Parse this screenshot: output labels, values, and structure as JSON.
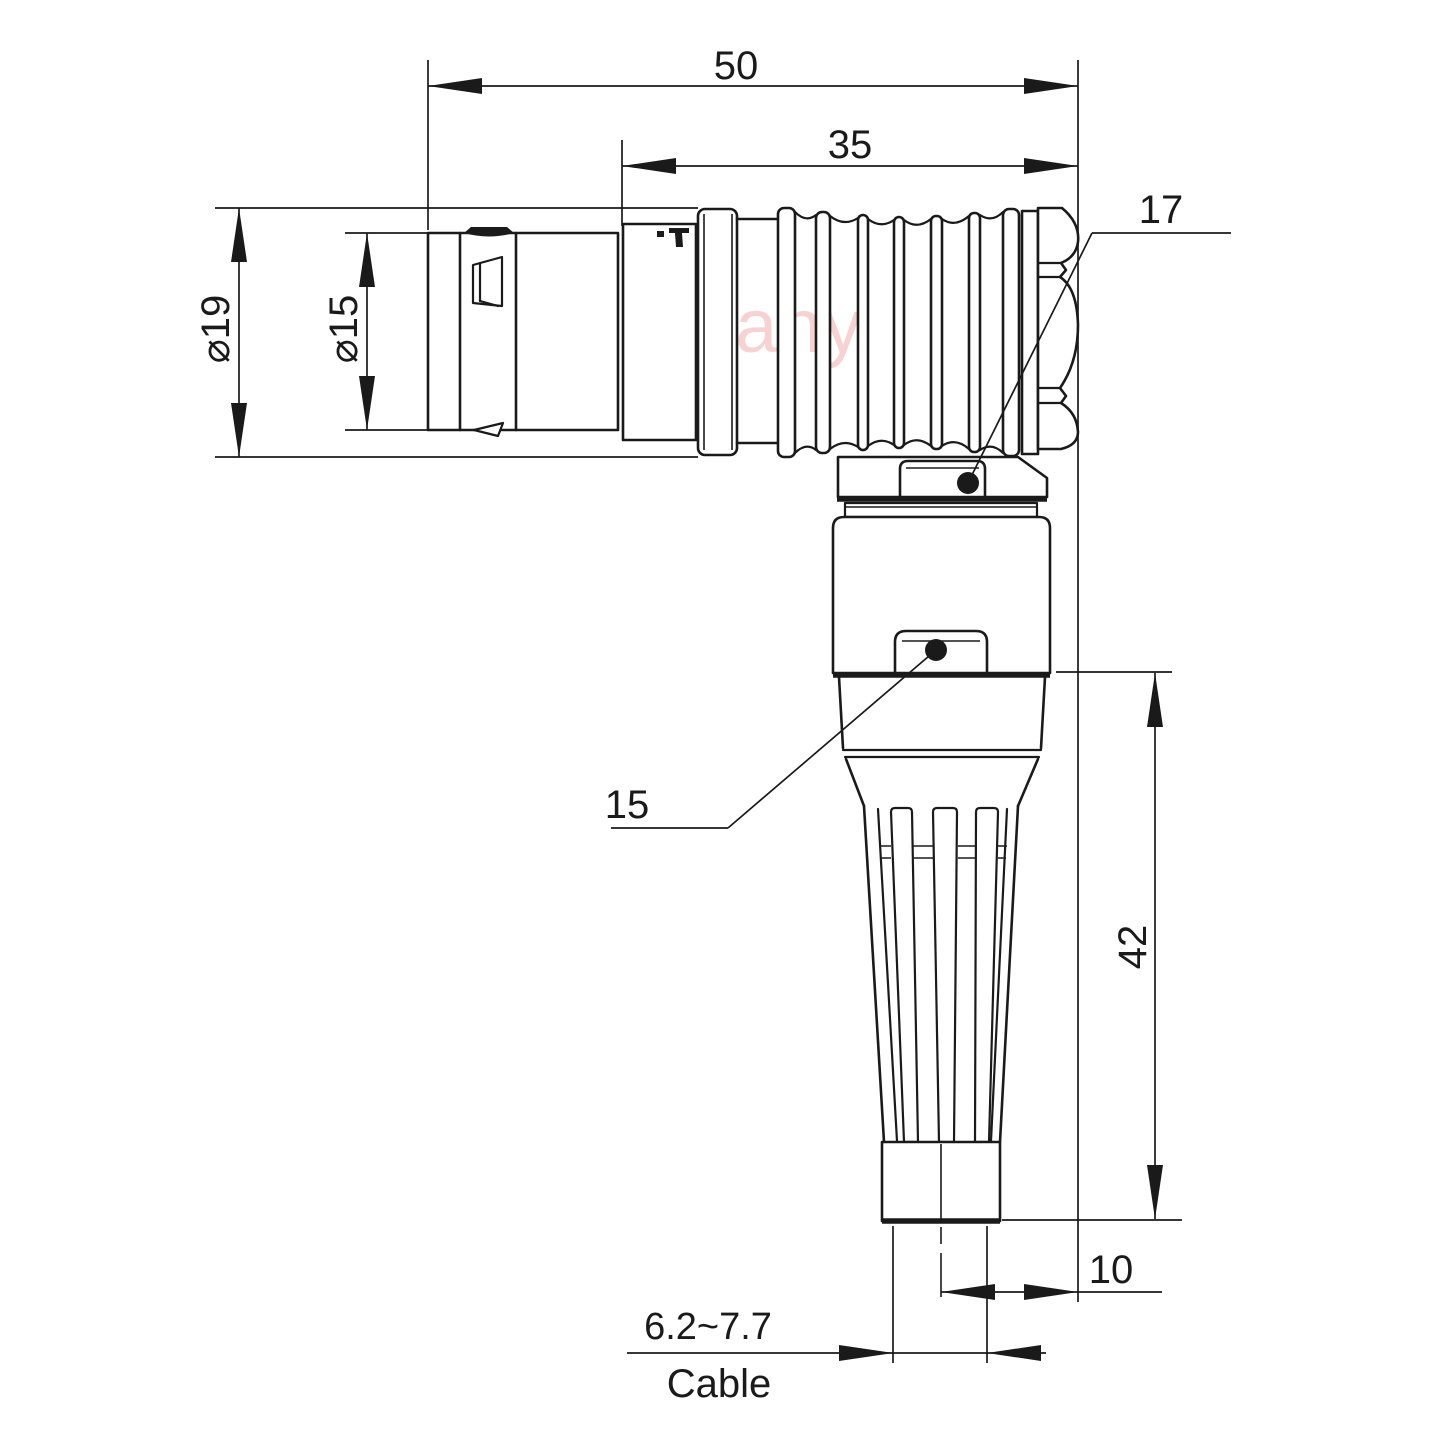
{
  "watermark": {
    "text": "Lightany",
    "color": "#f7d2d2"
  },
  "drawing": {
    "line_color": "#1a1a1a",
    "dimensions": {
      "overall_length": "50",
      "front_section_length": "35",
      "outer_diameter": "⌀19",
      "mating_diameter": "⌀15",
      "vertical_length": "42",
      "cable_axis_offset": "10",
      "cable_diameter_range": "6.2~7.7",
      "cable_caption": "Cable"
    },
    "callouts": {
      "back_nut_ref": "17",
      "elbow_body_ref": "15"
    }
  }
}
